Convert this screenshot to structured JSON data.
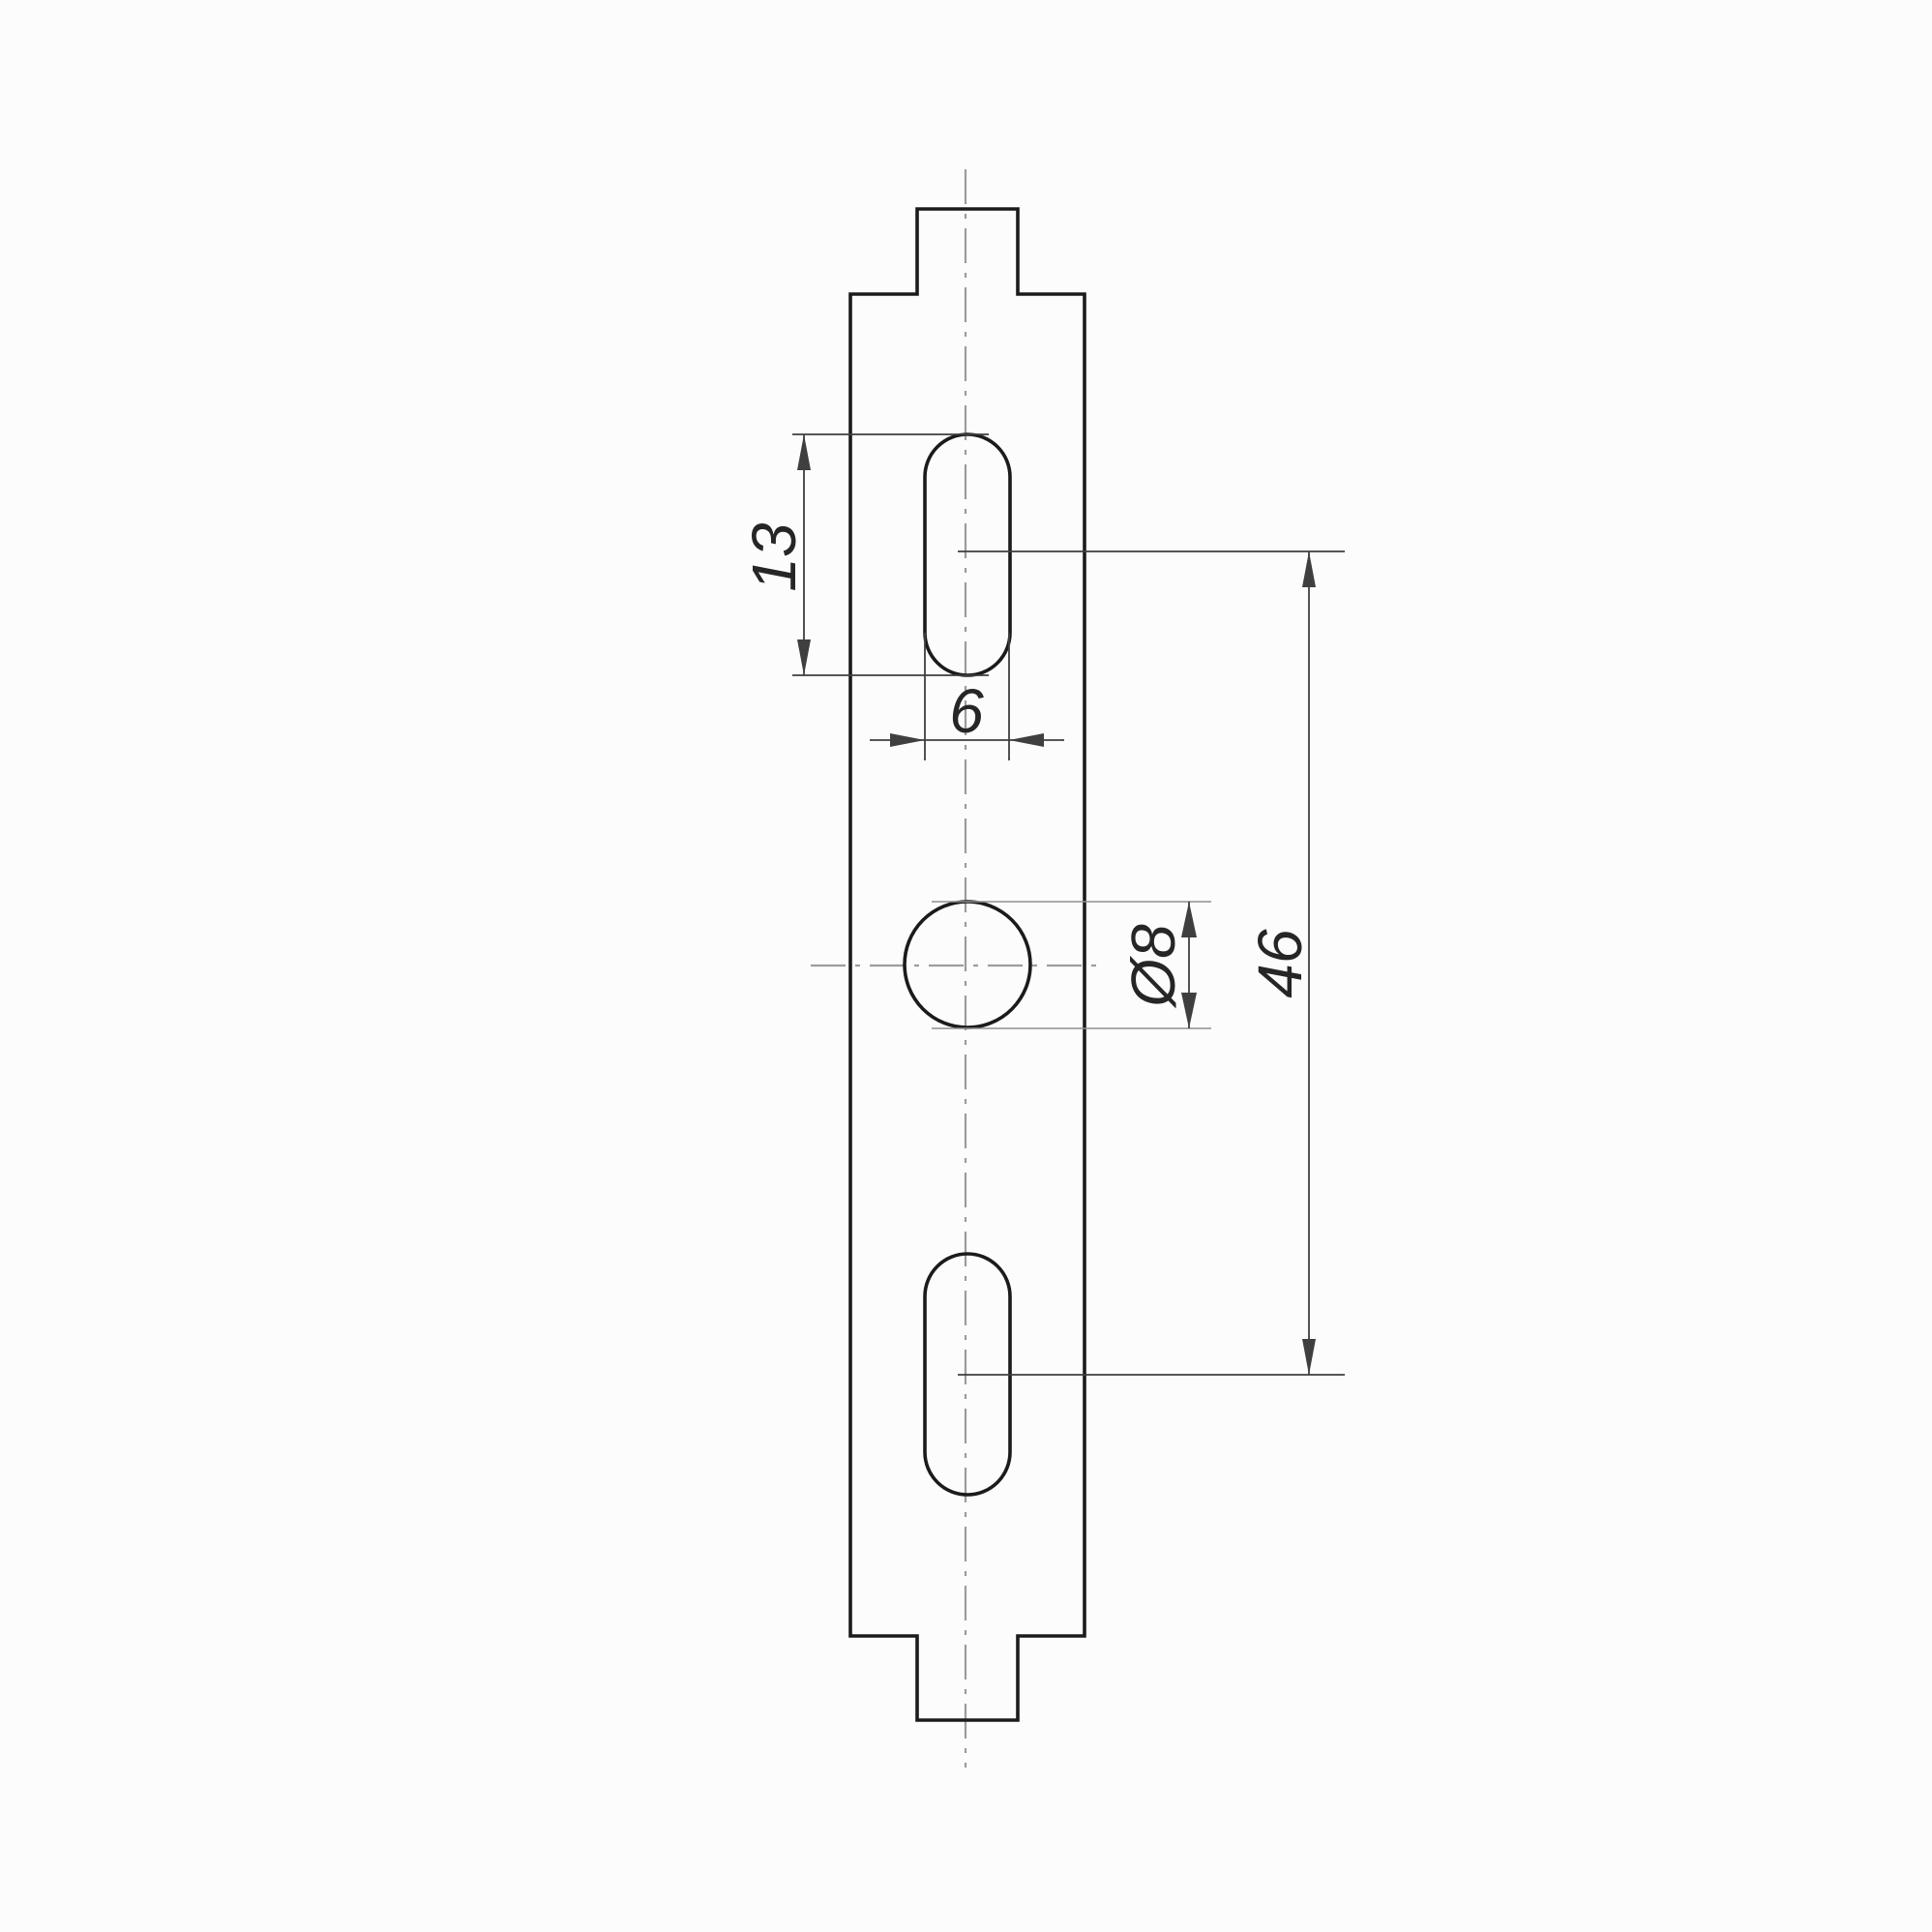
{
  "colors": {
    "background": "#fcfcfc",
    "outline": "#1b1b1b",
    "dimension": "#3f3f3f",
    "extension_light": "#8f8f8f",
    "centerline": "#9c9c9c",
    "text": "#262626"
  },
  "dimensions": {
    "slot_length": {
      "label": "13",
      "value": 13
    },
    "slot_width": {
      "label": "6",
      "value": 6
    },
    "hole_diameter": {
      "label": "Ø8",
      "value": 8
    },
    "hole_spacing": {
      "label": "46",
      "value": 46
    }
  }
}
